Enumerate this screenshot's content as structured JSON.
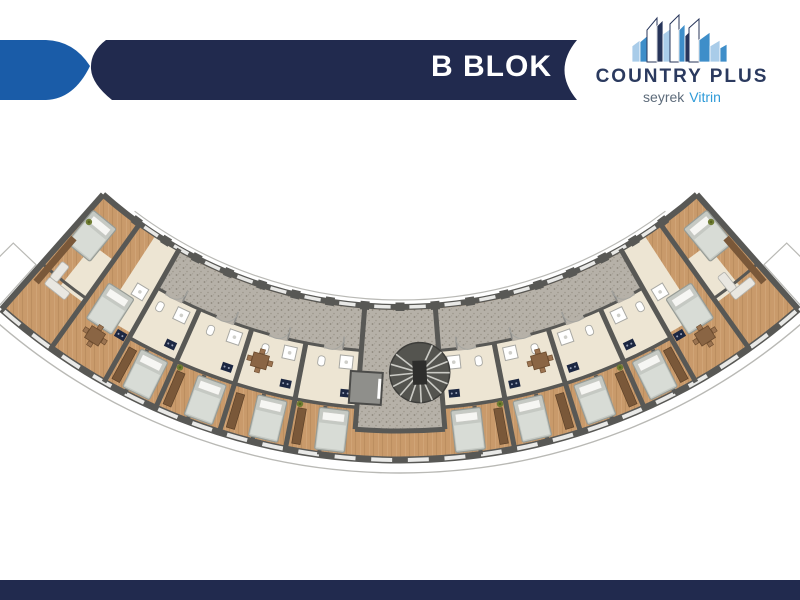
{
  "header": {
    "title": "B BLOK"
  },
  "logo": {
    "name": "COUNTRY PLUS",
    "tagline_left": "seyrek",
    "tagline_right": "Vitrin"
  },
  "colors": {
    "ribbon-navy": "#212a4e",
    "ribbon-blue": "#1a5ca8",
    "logo-navy": "#2b3a5f",
    "logo-gray": "#5d6b7a",
    "logo-blue": "#2f9bd8",
    "sky-light": "#a9cce9",
    "sky-mid": "#3e8ec9",
    "sky-navy": "#27355a",
    "wood": "#c99a6b",
    "wood2": "#b5875a",
    "wood-light": "#dcb68c",
    "beige": "#ede5d3",
    "corridor": "#b6b1a8",
    "speck1": "#8e887c",
    "speck2": "#9c968b",
    "wall": "#585855",
    "window": "#e9e9e7",
    "rail": "#b9b9b5",
    "bed": "#c5c9c3",
    "bed-stroke": "#979c96",
    "blanket": "#d8dcd6",
    "pillow": "#f6f6f3",
    "wardrobe": "#7a5839",
    "table": "#8a6544",
    "navy-appliance": "#1c2742",
    "green": "#6f7d33",
    "elevator": "#8f8f8b",
    "stair-dark": "#54544f",
    "stair-tread": "#cbcbc5"
  },
  "floorplan": {
    "center": {
      "x": 400,
      "y": -141
    },
    "span_deg": 41.5,
    "radii": {
      "inner_wall": 448,
      "corridor_out": 493,
      "beige_out": 550,
      "outer_wall": 601,
      "balcony": 614,
      "inner_rail": 441,
      "stem_out": 572
    },
    "corridor_span_deg": 29.5,
    "stem_half_deg": 4.5,
    "partitions_deg": [
      11,
      17.5,
      24
    ],
    "full_partitions_deg": [
      29.5,
      35.5
    ],
    "cap_deg": 41.5,
    "sub_partitions_deg": [
      7.75,
      14.25,
      20.75,
      27.25
    ],
    "door_centers_deg": [
      7.75,
      14.25,
      20.75,
      27.25
    ],
    "windows": {
      "start": -40.2,
      "end": 40.2,
      "count": 24,
      "half_deg": 1.0
    },
    "piers": {
      "start": -36,
      "end": 36,
      "step": 4.5
    },
    "beige_patches": [
      [
        29.5,
        33,
        448,
        545
      ],
      [
        35.5,
        38.5,
        493,
        545
      ]
    ],
    "end_room_wall": {
      "r": 540,
      "a1": 35.5,
      "a2": 41.5
    },
    "cap_wardrobe_deg": 40.7,
    "beds": [
      {
        "a": 6.8,
        "r": 575
      },
      {
        "a": 13.3,
        "r": 575
      },
      {
        "a": 19.8,
        "r": 575
      },
      {
        "a": 26.3,
        "r": 575
      },
      {
        "a": 32.8,
        "r": 535
      },
      {
        "a": 39.3,
        "r": 487
      }
    ],
    "wardrobes": [
      {
        "a": 10.1,
        "r": 576
      },
      {
        "a": 16.6,
        "r": 576
      },
      {
        "a": 23.1,
        "r": 576
      },
      {
        "a": 28.6,
        "r": 576
      }
    ],
    "stoves": [
      {
        "a": 5.8,
        "r": 537
      },
      {
        "a": 12.3,
        "r": 537
      },
      {
        "a": 18.8,
        "r": 537
      },
      {
        "a": 25.3,
        "r": 537
      },
      {
        "a": 30.4,
        "r": 552
      }
    ],
    "showers": [
      {
        "a": 6.1,
        "r": 506
      },
      {
        "a": 12.6,
        "r": 506
      },
      {
        "a": 19.1,
        "r": 506
      },
      {
        "a": 25.6,
        "r": 506
      },
      {
        "a": 31.0,
        "r": 505
      }
    ],
    "toilets": [
      {
        "a": 8.9,
        "r": 508
      },
      {
        "a": 15.4,
        "r": 508
      },
      {
        "a": 21.9,
        "r": 508
      },
      {
        "a": 28.2,
        "r": 508
      }
    ],
    "dining": [
      {
        "a": 15.6,
        "r": 521
      },
      {
        "a": 32.6,
        "r": 566
      }
    ],
    "sofas": [
      {
        "a": 38.6,
        "r": 549
      }
    ],
    "plants": [
      {
        "a": 10.4,
        "r": 554
      },
      {
        "a": 23.4,
        "r": 554
      },
      {
        "a": 40.6,
        "r": 478
      }
    ],
    "stair": {
      "a": 2.2,
      "r": 514,
      "radius": 30
    },
    "elevator": {
      "a": -3.7,
      "r": 530,
      "size": 32
    }
  }
}
